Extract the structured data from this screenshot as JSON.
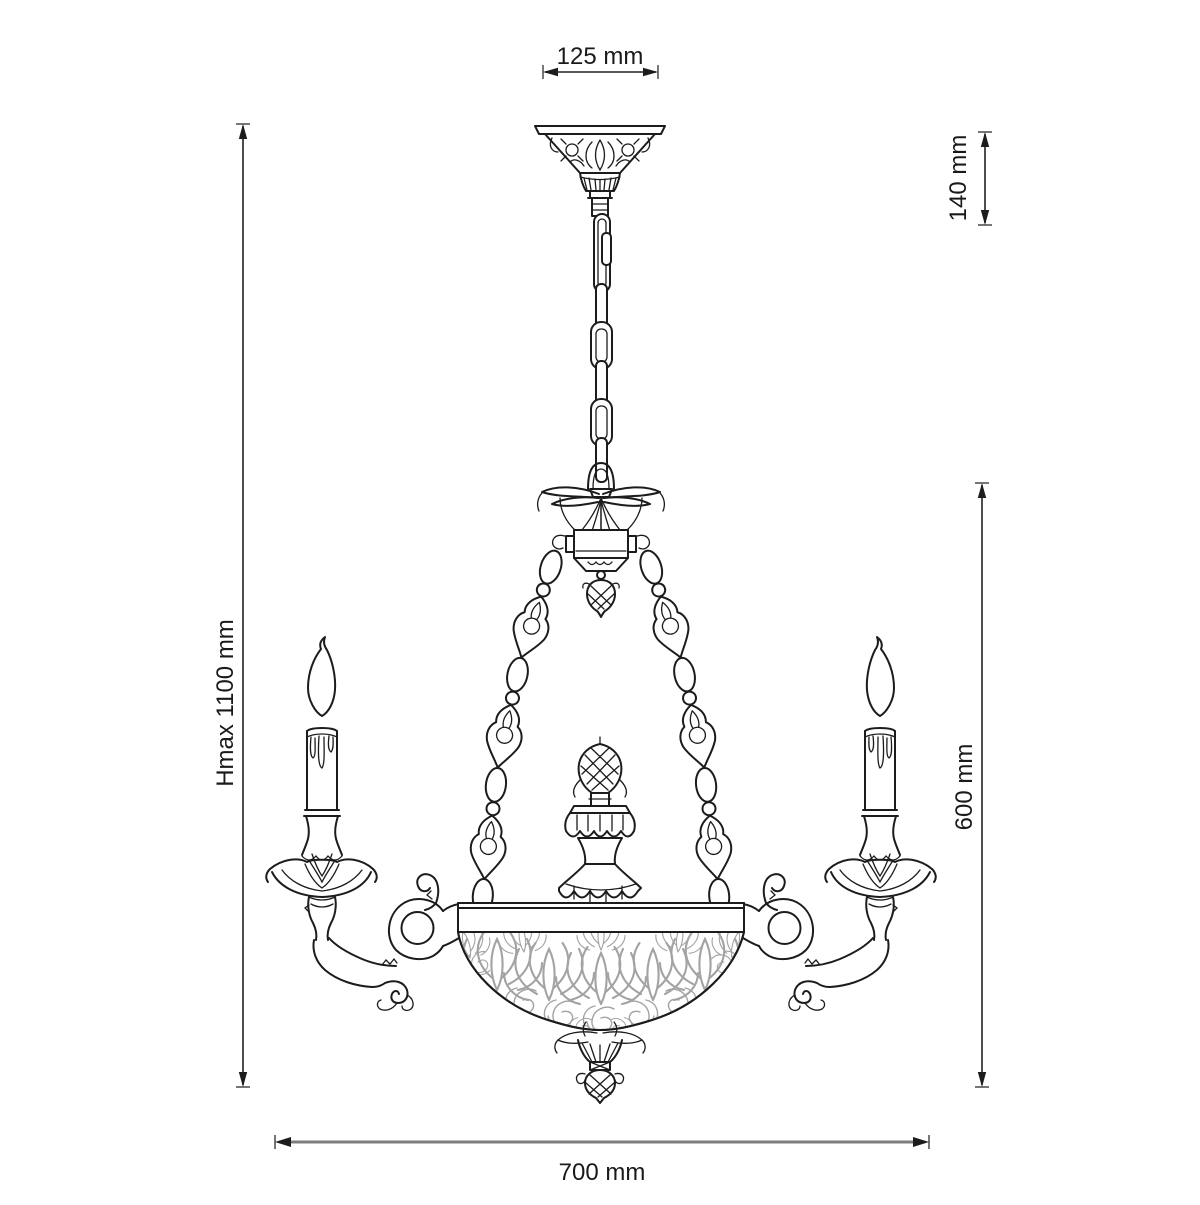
{
  "figure": {
    "title": "Chandelier dimensional line drawing",
    "style": "black outline technical illustration on white background",
    "colors": {
      "line": "#1c1c1c",
      "filigree": "#a3a3a3",
      "bottom_dimension_line": "#7d7d7d",
      "text": "#1a1a1a",
      "background": "#ffffff"
    }
  },
  "dimensions": {
    "canopy_width": {
      "label": "125 mm",
      "value": 125,
      "unit": "mm",
      "orientation": "horizontal",
      "location": "top"
    },
    "suspension_height": {
      "label": "140 mm",
      "value": 140,
      "unit": "mm",
      "orientation": "vertical",
      "location": "upper-right"
    },
    "max_height": {
      "label": "Hmax 1100 mm",
      "value": 1100,
      "unit": "mm",
      "orientation": "vertical",
      "location": "left"
    },
    "body_height": {
      "label": "600 mm",
      "value": 600,
      "unit": "mm",
      "orientation": "vertical",
      "location": "right"
    },
    "body_width": {
      "label": "700 mm",
      "value": 700,
      "unit": "mm",
      "orientation": "horizontal",
      "location": "bottom"
    }
  }
}
